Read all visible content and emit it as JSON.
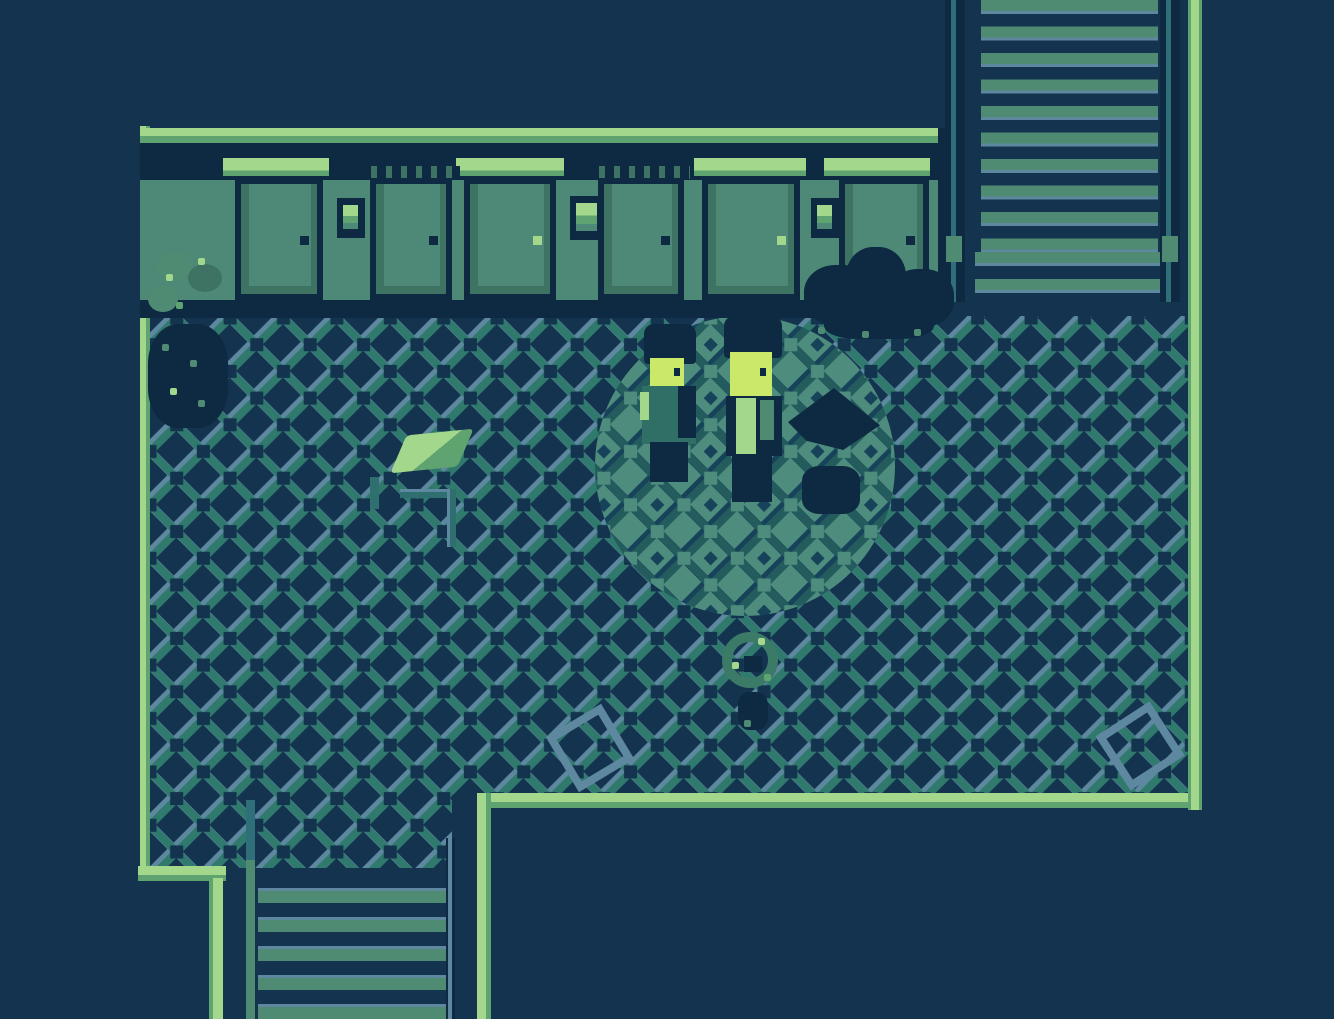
{
  "scene": {
    "name": "retro-rpg-hotel-corridor",
    "description": "Top-down Game Boy style corridor: row of doors along the top wall, tiled floor, upper-right ascending staircase, lower-left descending staircase, two characters standing in a pool of light",
    "objects": {
      "doors": {
        "count": 6,
        "with_transom_window": [
          1,
          3,
          5,
          6
        ],
        "with_plain_lintel": [
          2,
          4
        ]
      },
      "nameplates": {
        "count": 3
      },
      "staircase_upper_right": {
        "direction": "up",
        "steps_visible": 12
      },
      "staircase_lower_left": {
        "direction": "down",
        "steps_visible": 5
      },
      "characters": [
        {
          "id": "character-left",
          "pose": "standing",
          "lit": true
        },
        {
          "id": "character-right",
          "pose": "standing",
          "lit": true
        }
      ],
      "props": [
        "potted-plant",
        "shadow-bush",
        "dropped-paper",
        "floor-scrape-marks",
        "small-figure-in-dark",
        "loose-tile-left",
        "loose-tile-right"
      ]
    }
  },
  "palette": {
    "bg_navy": "#13334E",
    "outline_navy": "#0E2A42",
    "wall_green": "#4E8977",
    "wall_green_dark": "#3E7263",
    "highlight": "#A3D88C",
    "highlight_mid": "#5FA371",
    "floor_stroke_teal": "#2F7A6D",
    "floor_stroke_slate": "#5E87A0",
    "lit_floor": "#4E8D7D",
    "lit_stroke": "#245C5E",
    "lit_deep": "#16425A",
    "face_yellow": "#CBE969",
    "step_green": "#4F8A72",
    "teal_rail": "#2F6F7A",
    "mark_teal": "#2F6F70"
  }
}
